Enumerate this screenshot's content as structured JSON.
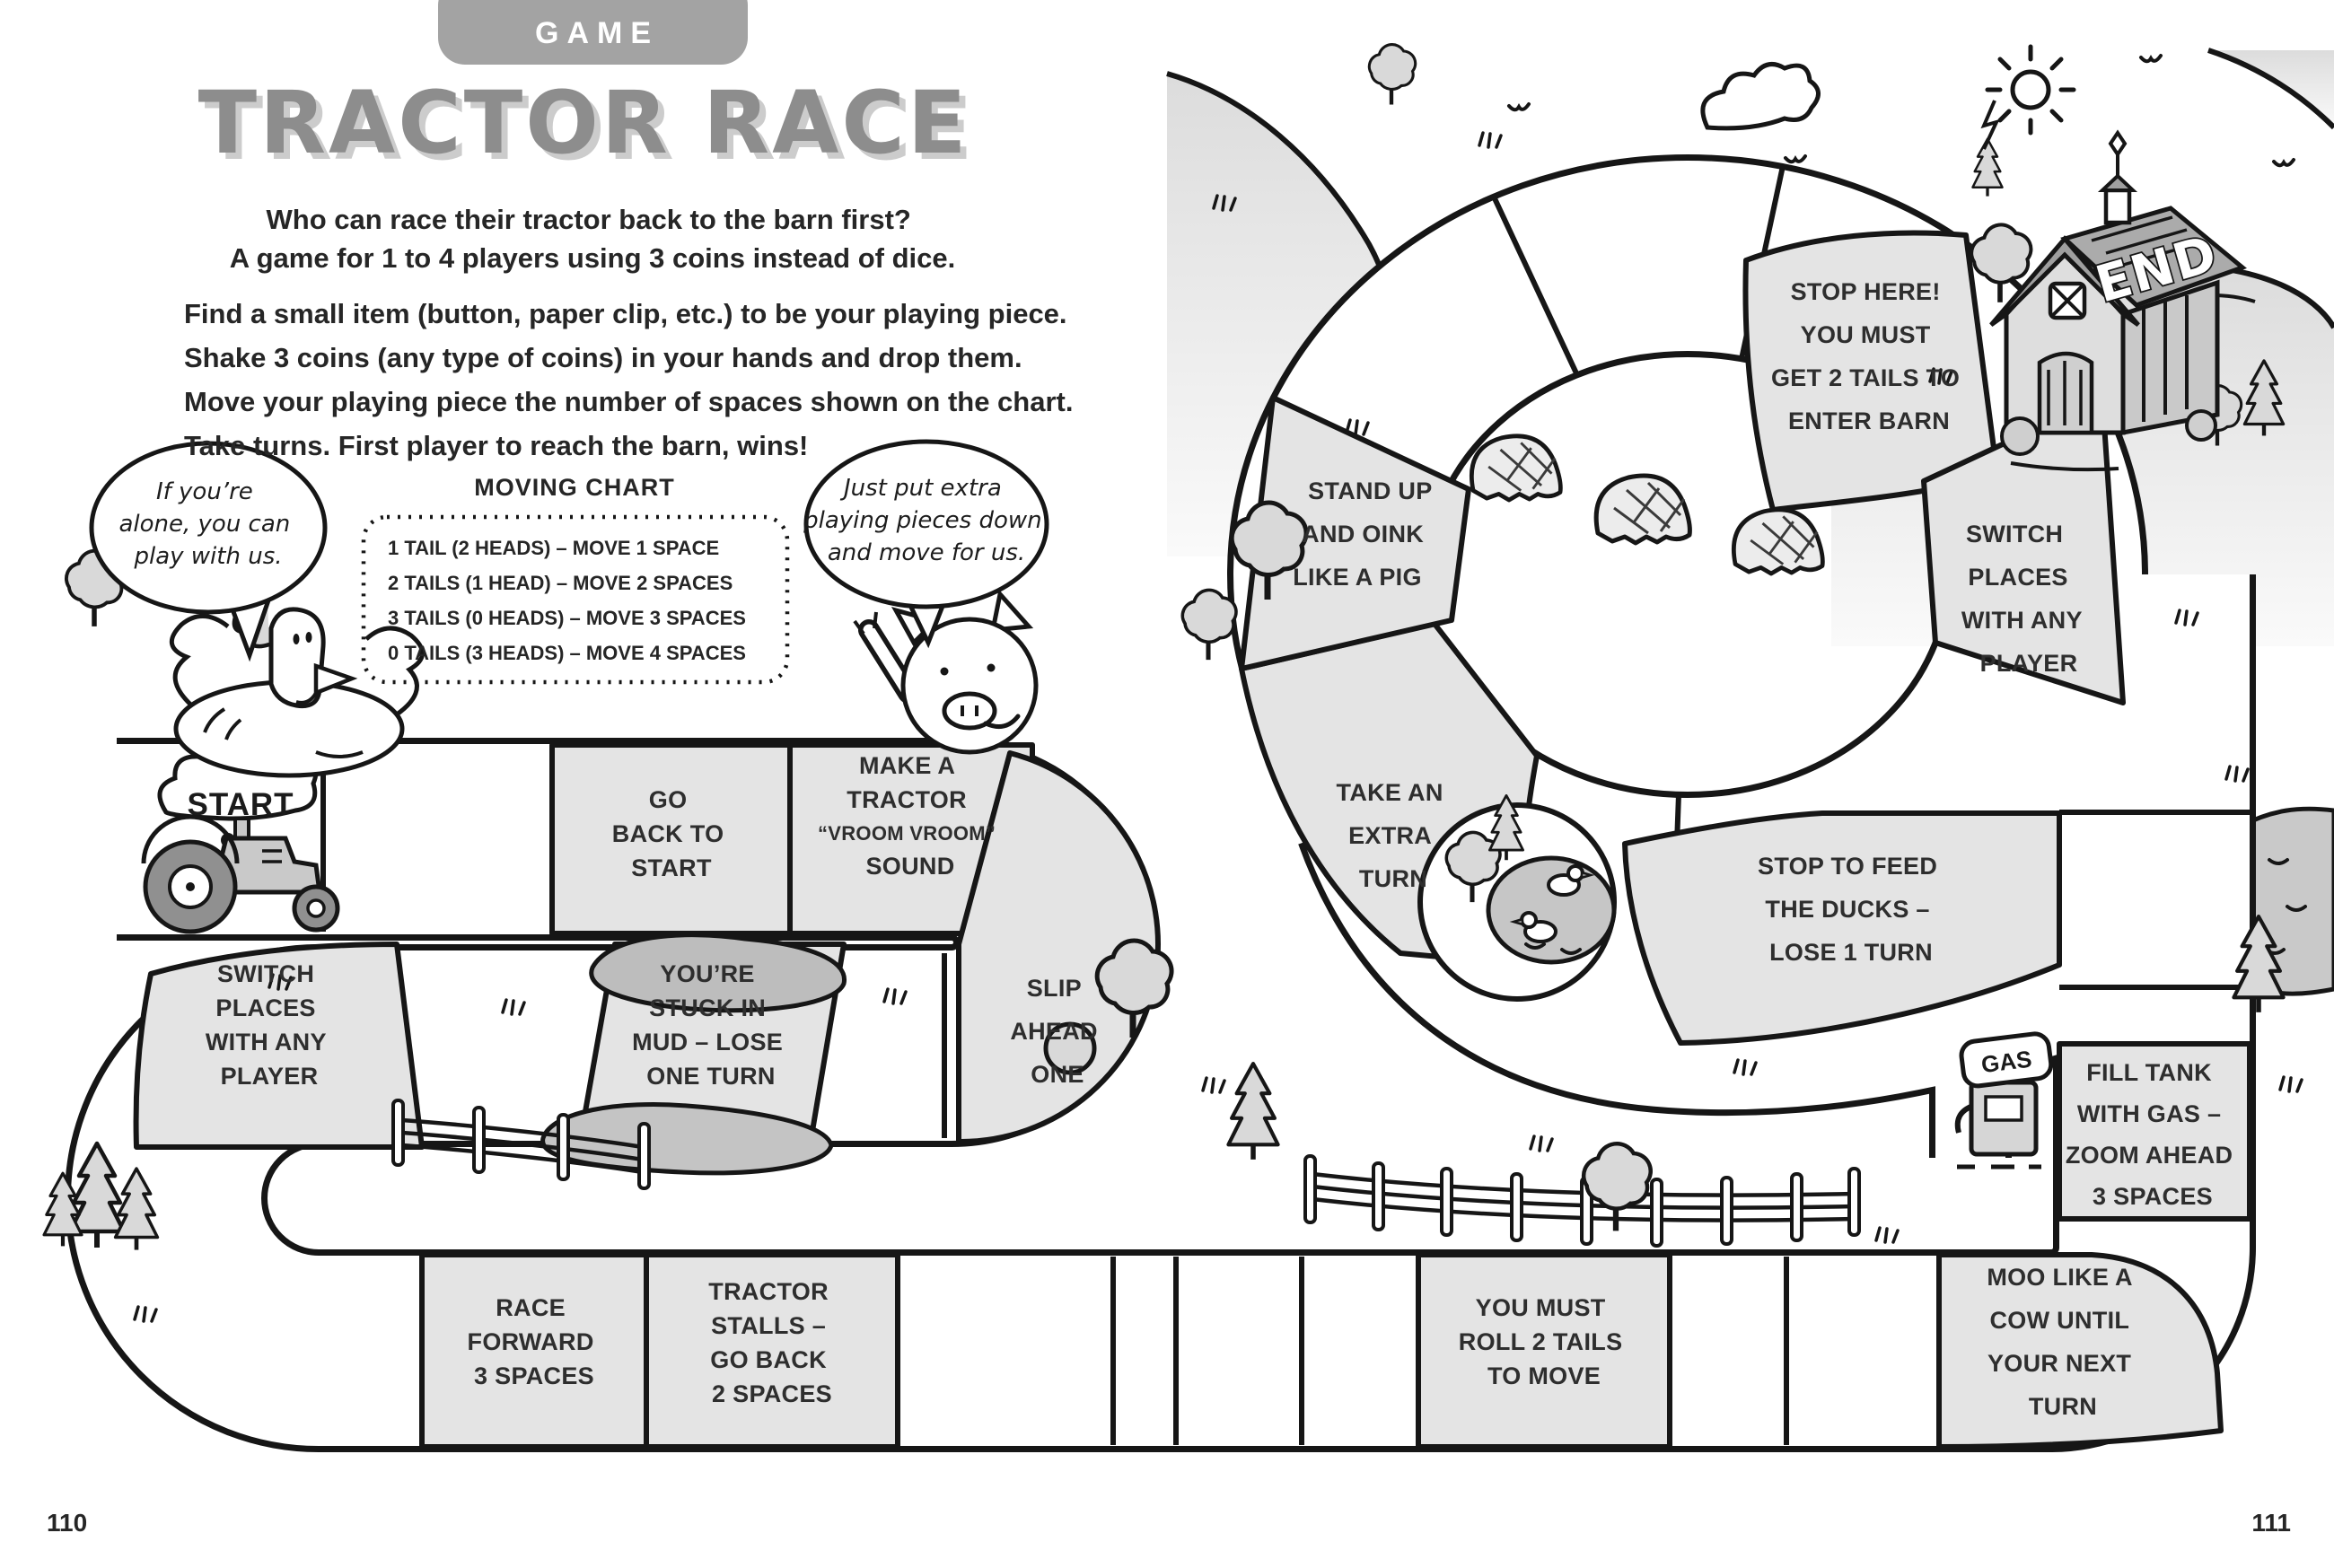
{
  "page_numbers": {
    "left": "110",
    "right": "111"
  },
  "header": {
    "badge": "GAME",
    "title": "TRACTOR RACE",
    "subtitle": [
      "Who can race their tractor back to the barn first?",
      "A game for 1 to 4 players using 3 coins instead of dice."
    ],
    "instructions": [
      "Find a small item (button, paper clip, etc.) to be your playing piece.",
      "Shake 3 coins (any type of coins) in your hands and drop them.",
      "Move your playing piece the number of spaces shown on the chart.",
      "Take turns. First player to reach the barn, wins!"
    ]
  },
  "moving_chart": {
    "title": "MOVING CHART",
    "rows": [
      "1 TAIL (2 HEADS) – MOVE 1 SPACE",
      "2 TAILS (1 HEAD) – MOVE 2 SPACES",
      "3 TAILS (0 HEADS) – MOVE 3 SPACES",
      "0 TAILS (3 HEADS) – MOVE 4 SPACES"
    ]
  },
  "speech_bubbles": {
    "chicken": [
      "If you’re",
      "alone, you can",
      "play with us."
    ],
    "pig": [
      "Just put extra",
      "playing pieces down",
      "and move for us."
    ]
  },
  "board": {
    "start_label": "START",
    "end_label": "END",
    "gas_label": "GAS",
    "cells": {
      "go_back_to_start": [
        "GO",
        "BACK TO",
        "START"
      ],
      "make_a_tractor": [
        "MAKE A",
        "TRACTOR",
        "“VROOM VROOM”",
        "SOUND"
      ],
      "slip_ahead_one": [
        "SLIP",
        "AHEAD",
        "ONE"
      ],
      "stuck_in_mud": [
        "YOU’RE",
        "STUCK IN",
        "MUD – LOSE",
        "ONE TURN"
      ],
      "switch_places_left": [
        "SWITCH",
        "PLACES",
        "WITH ANY",
        "PLAYER"
      ],
      "race_forward": [
        "RACE",
        "FORWARD",
        "3 SPACES"
      ],
      "tractor_stalls": [
        "TRACTOR",
        "STALLS –",
        "GO BACK",
        "2 SPACES"
      ],
      "you_must_roll": [
        "YOU MUST",
        "ROLL 2 TAILS",
        "TO MOVE"
      ],
      "moo_like_a_cow": [
        "MOO LIKE A",
        "COW UNTIL",
        "YOUR NEXT",
        "TURN"
      ],
      "fill_tank": [
        "FILL TANK",
        "WITH GAS –",
        "ZOOM AHEAD",
        "3 SPACES"
      ],
      "stop_to_feed": [
        "STOP TO FEED",
        "THE DUCKS –",
        "LOSE 1 TURN"
      ],
      "take_extra_turn": [
        "TAKE AN",
        "EXTRA",
        "TURN"
      ],
      "stand_up_oink": [
        "STAND UP",
        "AND OINK",
        "LIKE A PIG"
      ],
      "switch_places_right": [
        "SWITCH",
        "PLACES",
        "WITH ANY",
        "PLAYER"
      ],
      "stop_here": [
        "STOP HERE!",
        "YOU MUST",
        "GET 2 TAILS TO",
        "ENTER BARN"
      ]
    }
  }
}
